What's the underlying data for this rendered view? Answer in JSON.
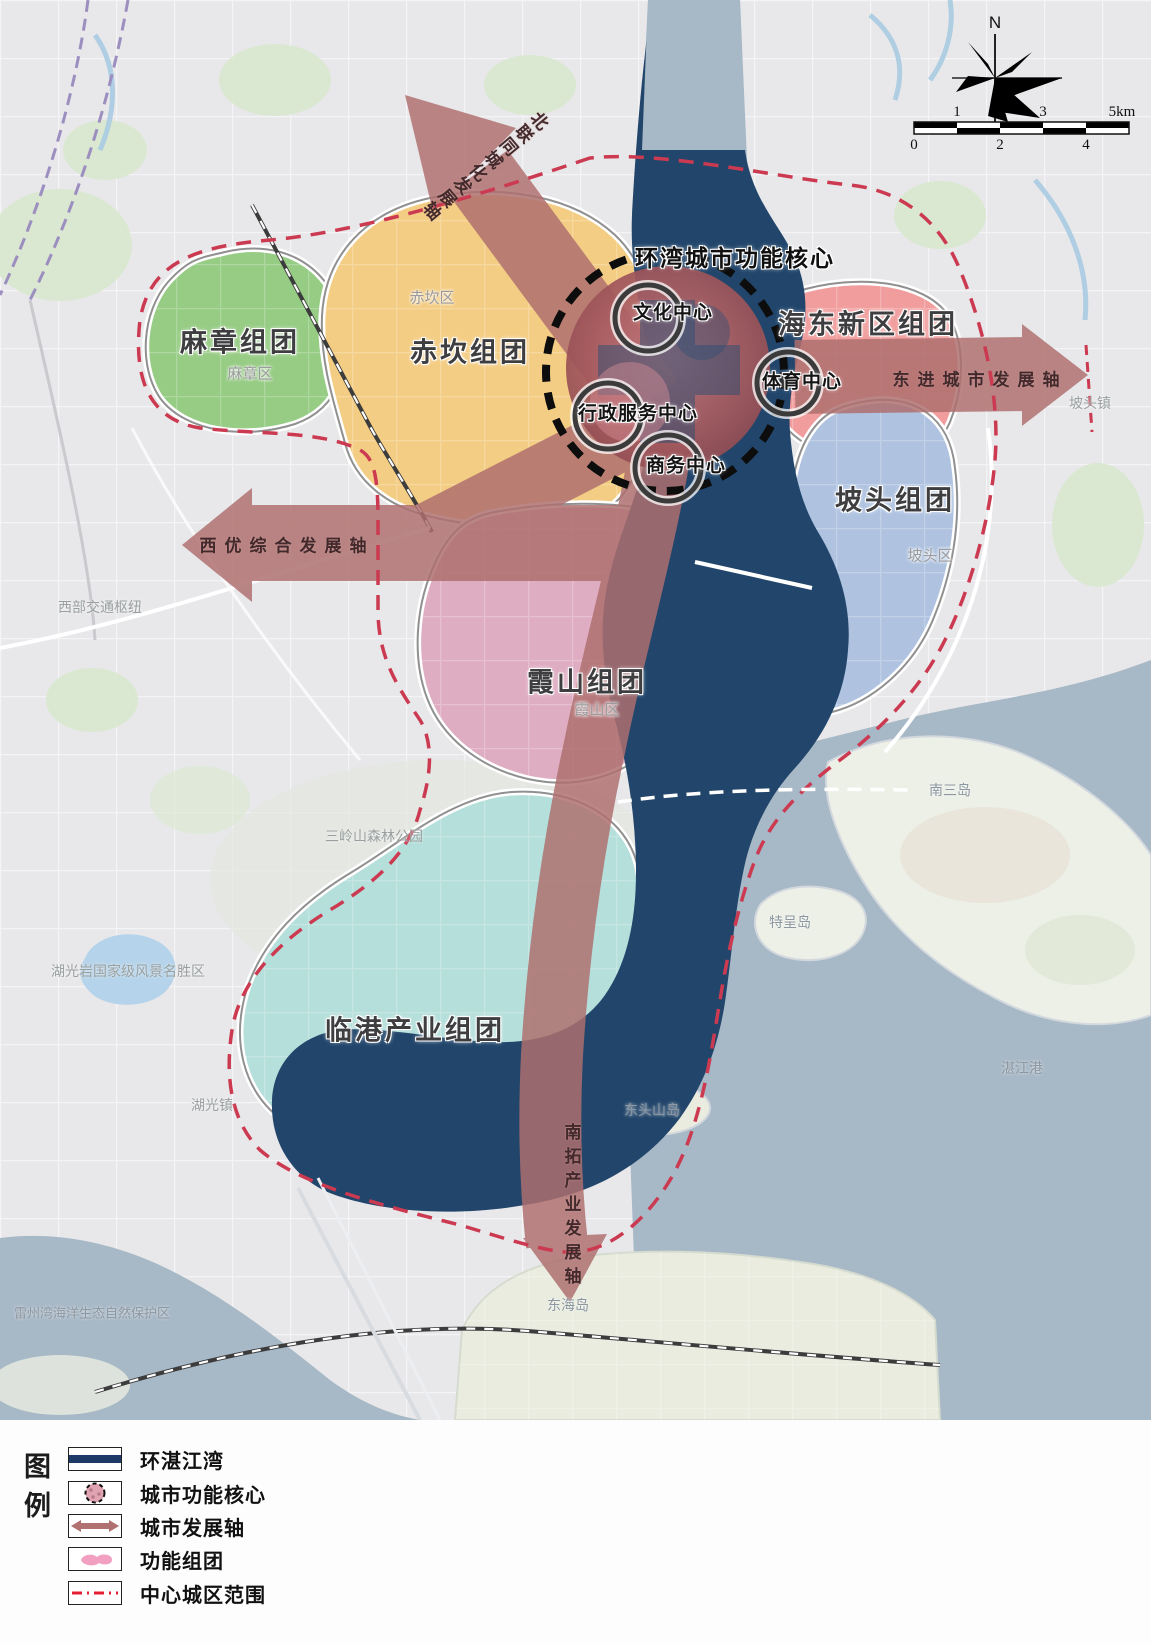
{
  "compass": {
    "north_label": "N"
  },
  "scale_bar": {
    "top_labels": [
      "1",
      "3",
      "5km"
    ],
    "bottom_labels": [
      "0",
      "2",
      "4"
    ]
  },
  "core": {
    "title": "环湾城市功能核心",
    "centers": {
      "culture": "文化中心",
      "sports": "体育中心",
      "admin": "行政服务中心",
      "business": "商务中心"
    }
  },
  "axes": {
    "north": "北联同城化发展轴",
    "east": "东进城市发展轴",
    "west": "西优综合发展轴",
    "south": "南拓产业发展轴"
  },
  "clusters": {
    "mazhang": "麻章组团",
    "chikan": "赤坎组团",
    "haidong": "海东新区组团",
    "potou": "坡头组团",
    "xiashan": "霞山组团",
    "lingang": "临港产业组团"
  },
  "districts": {
    "chikan": "赤坎区",
    "mazhang": "麻章区",
    "xiashan": "霞山区",
    "potou": "坡头区"
  },
  "places": {
    "potou_town": "坡头镇",
    "huguang_town": "湖光镇",
    "donghai_island": "东海岛",
    "nansan_island": "南三岛",
    "techeng_island": "特呈岛",
    "dongtoushan_island": "东头山岛",
    "zhanjiang_port": "湛江港",
    "sanlingshan_park": "三岭山森林公园",
    "huguangyan_scenic": "湖光岩国家级风景名胜区",
    "west_transport_hub": "西部交通枢纽",
    "leizhou_bay_reserve": "雷州湾海洋生态自然保护区"
  },
  "legend": {
    "title": "图例",
    "items": [
      {
        "label": "环湛江湾"
      },
      {
        "label": "城市功能核心"
      },
      {
        "label": "城市发展轴"
      },
      {
        "label": "功能组团"
      },
      {
        "label": "中心城区范围"
      }
    ]
  },
  "colors": {
    "bay_navy": "#22466b",
    "sea": "#a7b8c6",
    "land": "#e8e8ea",
    "axis_red": "#ae6f6e",
    "boundary_red": "#cb3a50",
    "cluster_mazhang": "#97cc85",
    "cluster_chikan": "#f4cd84",
    "cluster_haidong": "#f19d9d",
    "cluster_potou": "#afc3e1",
    "cluster_xiashan": "#dfadc2",
    "cluster_lingang": "#b5dfdb",
    "legend_pink": "#f2a0c2",
    "core_red": "#a85c60"
  }
}
